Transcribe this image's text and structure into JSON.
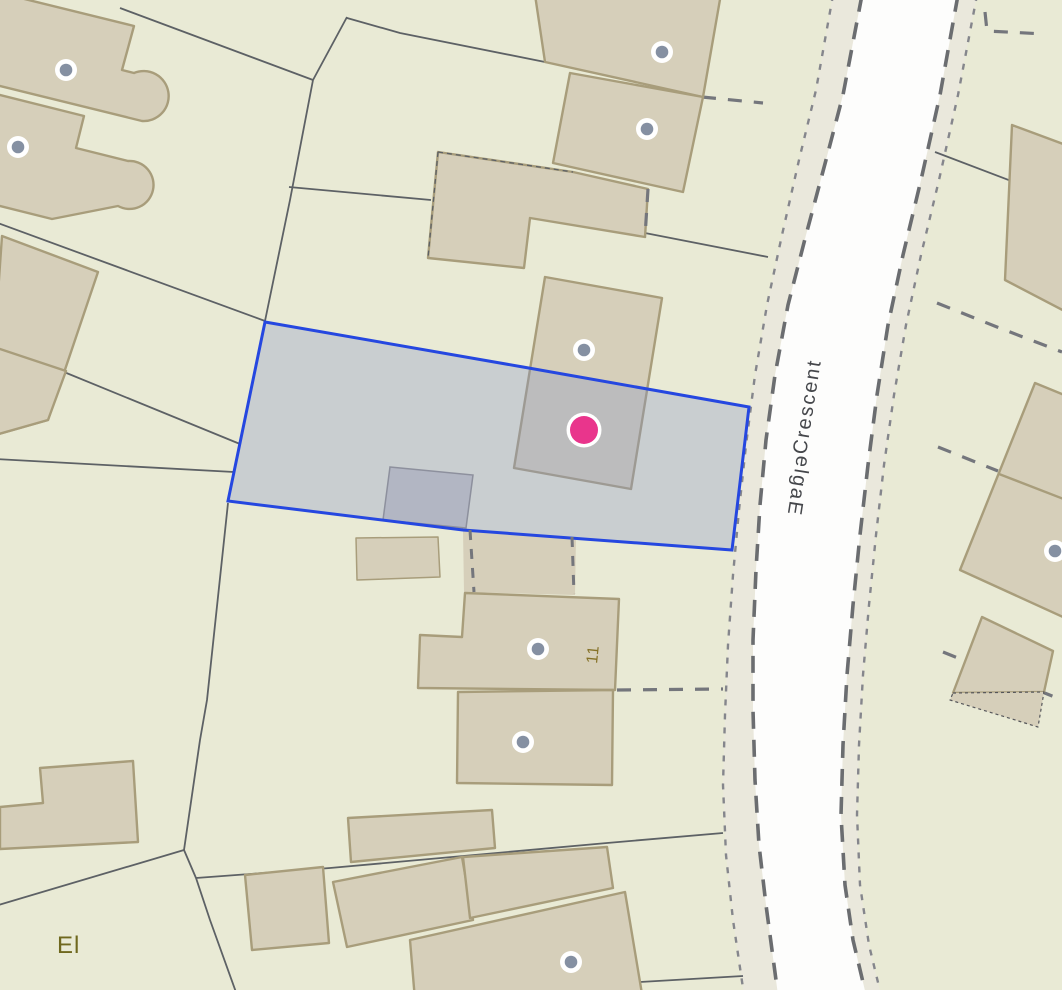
{
  "map": {
    "type": "cadastral-parcel-map",
    "road": {
      "name": "Eagle Crescent",
      "label_display": {
        "upper": "Crescent",
        "lower_flipped": "elgaE"
      }
    },
    "labels": {
      "house_number": "11",
      "substation_partial": "El"
    },
    "marker": {
      "name": "selected-location-marker",
      "color": "#e9358c",
      "ring_color": "#ffffff"
    },
    "selected_parcel": {
      "outline_color": "#2547e0",
      "fill": "rgba(138,148,196,0.33)"
    },
    "icons": {
      "address_point": "gray-dot-with-white-ring",
      "location_marker": "pink-dot-with-white-ring"
    },
    "colors": {
      "background": "#e9ead5",
      "building_fill": "#d6cfba",
      "building_stroke": "#a89d7b",
      "shed_fill": "#c7c6c2",
      "road_fill": "#fdfdfc",
      "verge_fill": "#eae8dc",
      "boundary_line": "#5d6165",
      "boundary_dashed": "#74767c",
      "road_casing": "#6b6d70",
      "road_dotted": "#85868c",
      "road_name_text": "#45474b",
      "house_number_text": "#857127",
      "substation_text": "#6f681e",
      "address_point": "#8590a2"
    }
  }
}
